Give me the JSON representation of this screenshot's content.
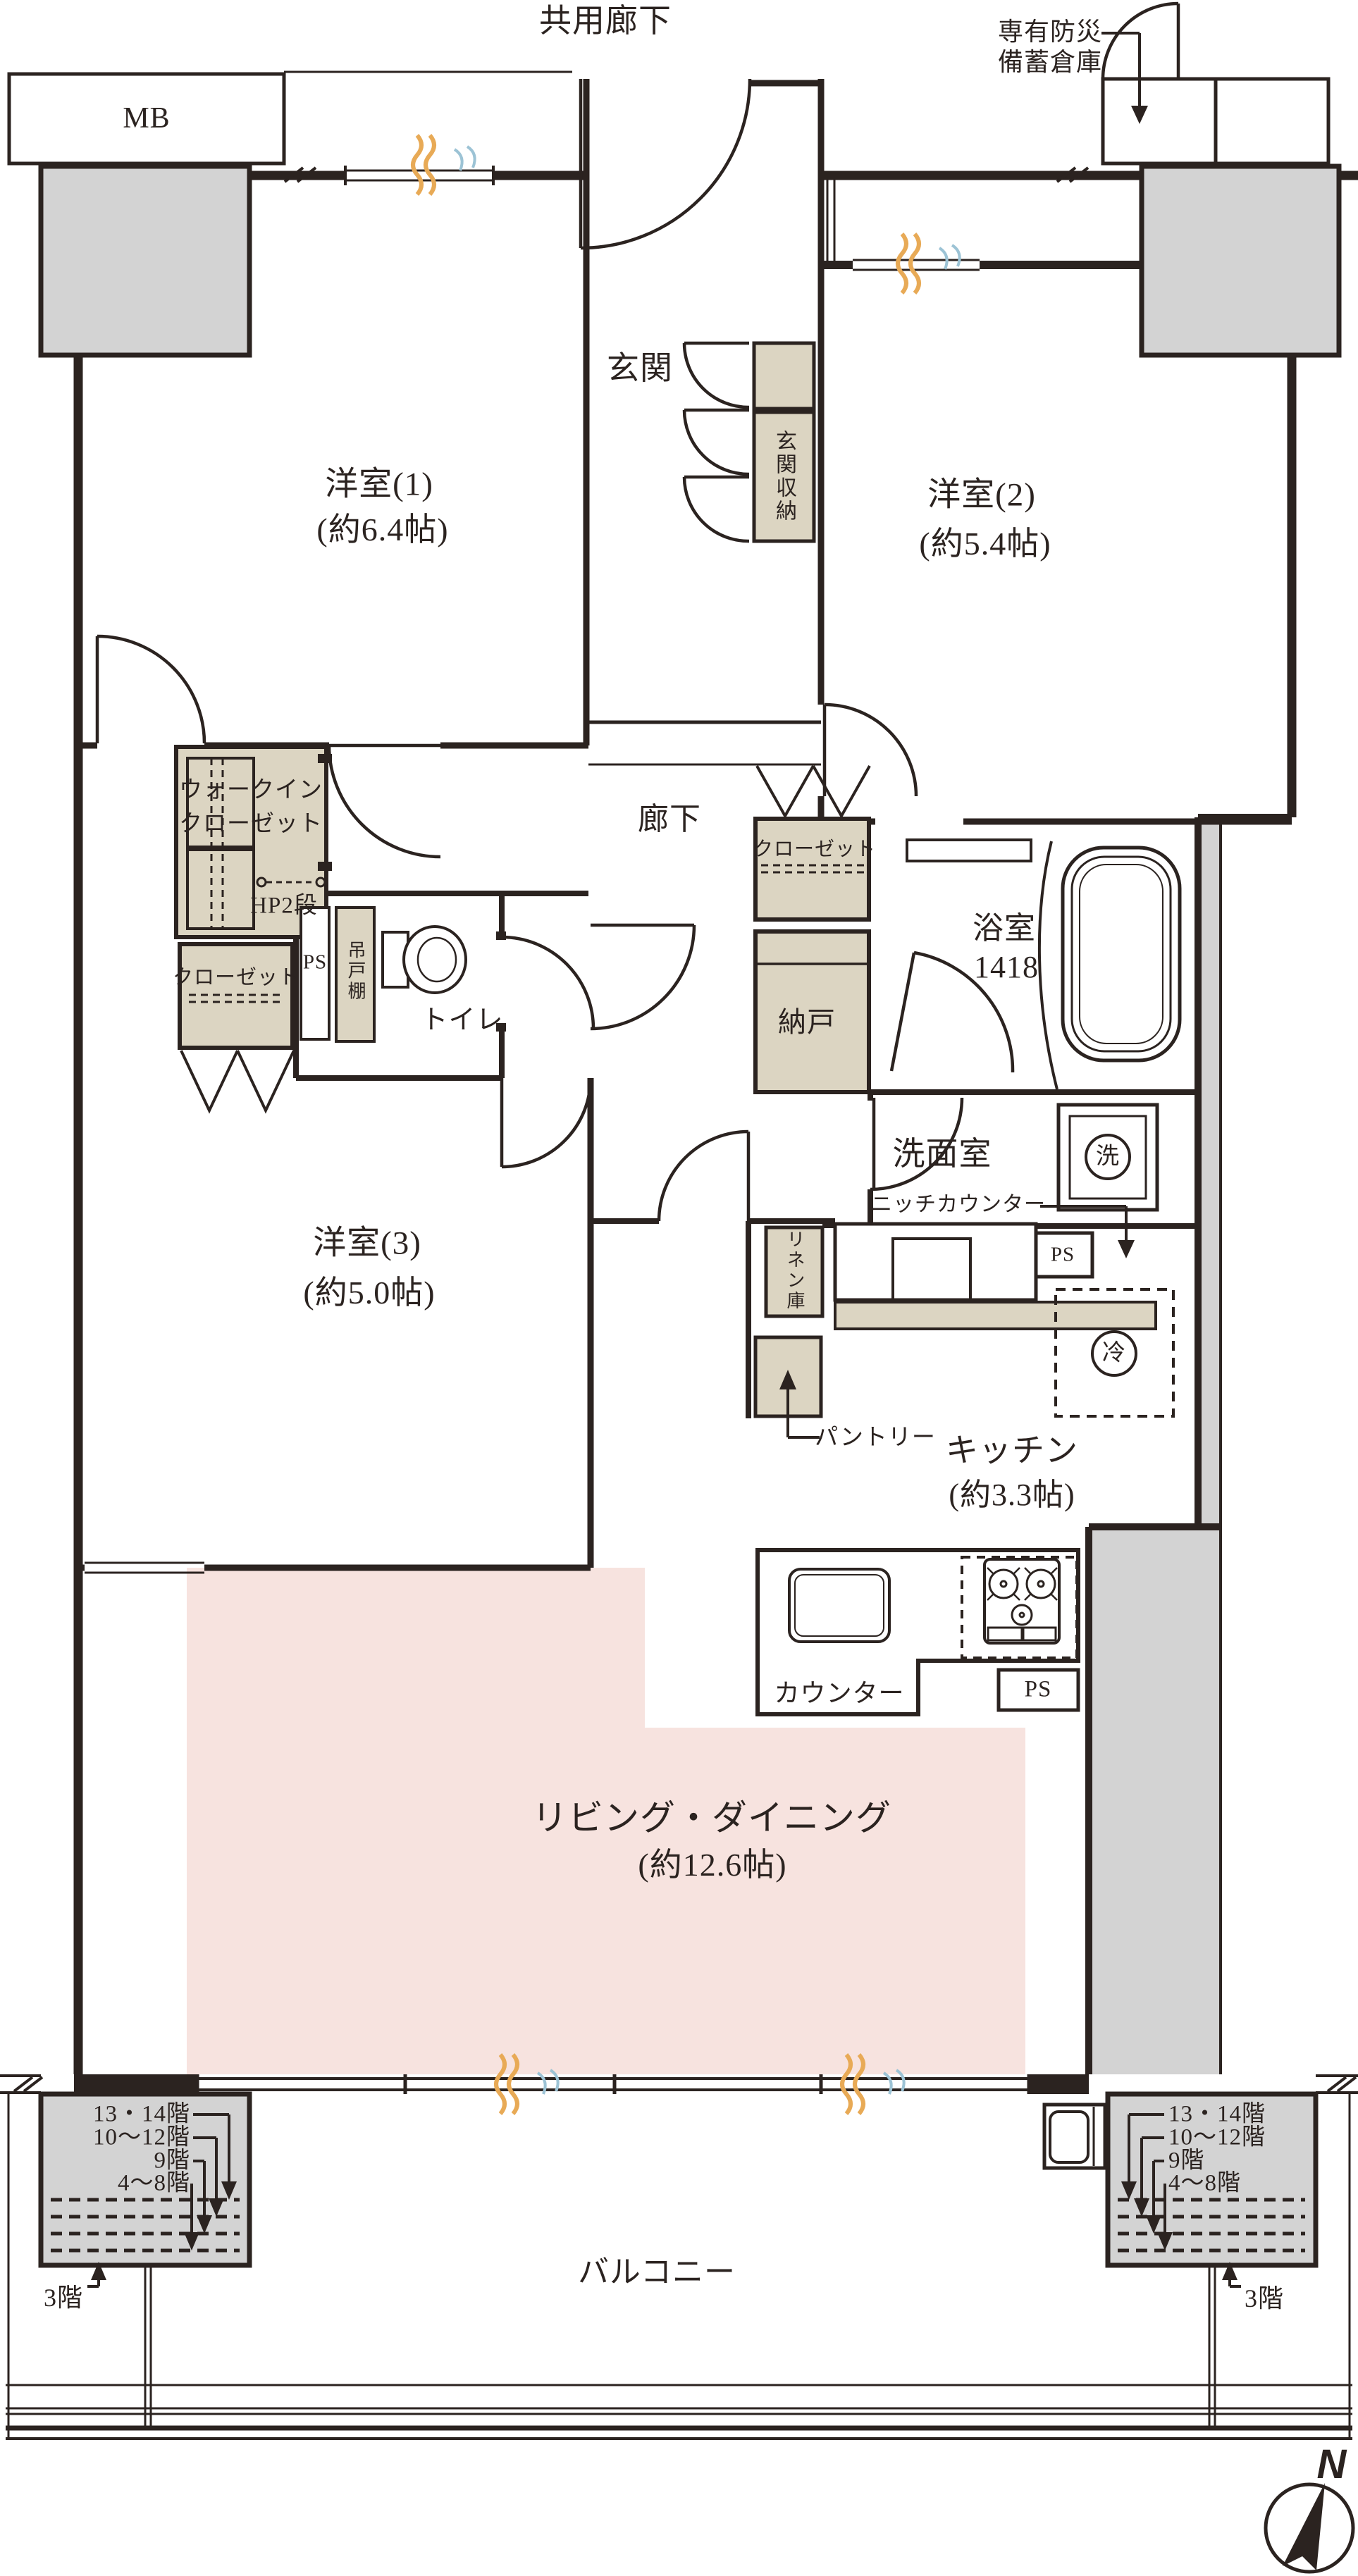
{
  "colors": {
    "line": "#2b2320",
    "beige": "#dcd5c2",
    "gray": "#d3d3d3",
    "pink": "#f7e3df",
    "orange": "#e8aa56",
    "blue": "#9cc3d5"
  },
  "header": {
    "common_corridor": "共用廊下",
    "disaster_storage_line1": "専有防災",
    "disaster_storage_line2": "備蓄倉庫",
    "meter_box": "MB"
  },
  "rooms": {
    "room1": {
      "name": "洋室(1)",
      "size": "(約6.4帖)"
    },
    "room2": {
      "name": "洋室(2)",
      "size": "(約5.4帖)"
    },
    "room3": {
      "name": "洋室(3)",
      "size": "(約5.0帖)"
    },
    "living_dining": {
      "name": "リビング・ダイニング",
      "size": "(約12.6帖)"
    },
    "kitchen": {
      "name": "キッチン",
      "size": "(約3.3帖)"
    },
    "bathroom": {
      "name": "浴室",
      "size": "1418"
    },
    "washroom": "洗面室",
    "toilet": "トイレ",
    "entrance": "玄関",
    "hallway": "廊下",
    "storage_room": "納戸",
    "balcony": "バルコニー"
  },
  "storage": {
    "entrance_storage": "玄関収納",
    "wic_line1": "ウォークイン",
    "wic_line2": "クローゼット",
    "wic_hp": "HP2段",
    "closet": "クローゼット",
    "hanging_cabinet": "吊戸棚",
    "linen": "リネン庫",
    "pantry": "パントリー",
    "niche_counter": "ニッチカウンター",
    "counter": "カウンター"
  },
  "fixtures": {
    "washer": "洗",
    "fridge": "冷",
    "pipe_space": "PS"
  },
  "floor_annotations": {
    "levels": [
      "13・14階",
      "10〜12階",
      "9階",
      "4〜8階"
    ],
    "third_floor": "3階"
  },
  "compass": {
    "north": "N"
  }
}
